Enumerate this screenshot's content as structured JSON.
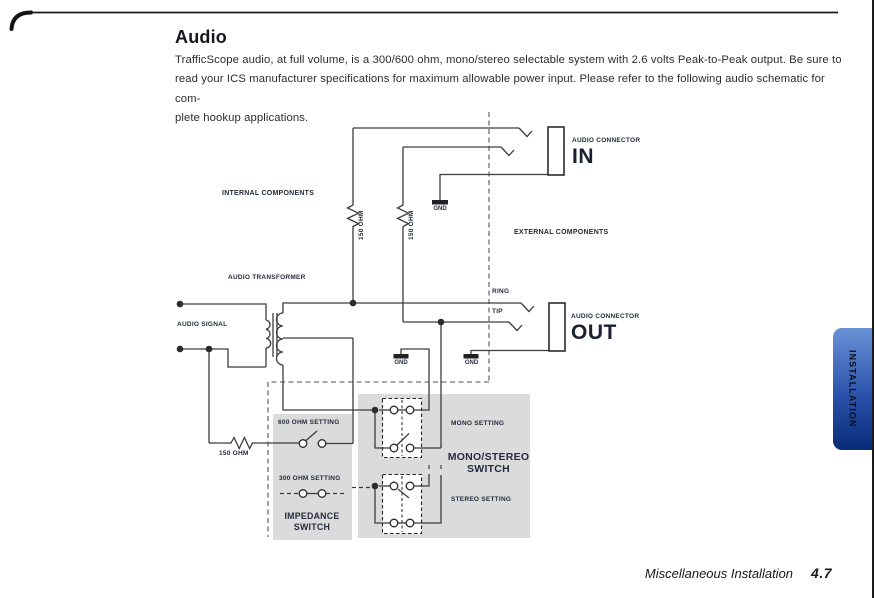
{
  "header": {
    "title": "Audio",
    "paragraph_lines": [
      "TrafficScope audio, at full volume, is a 300/600 ohm, mono/stereo selectable  system with 2.6 volts Peak-to-Peak output.  Be sure to",
      "read your ICS manufacturer specifications for maximum allowable power input. Please refer to the following audio schematic for com-",
      "plete hookup applications."
    ]
  },
  "tab": {
    "label": "INSTALLATION"
  },
  "footer": {
    "section": "Miscellaneous Installation",
    "page_number": "4.7"
  },
  "diagram": {
    "labels": {
      "internal": "INTERNAL COMPONENTS",
      "external": "EXTERNAL COMPONENTS",
      "audio_transformer": "AUDIO TRANSFORMER",
      "audio_signal": "AUDIO SIGNAL",
      "ring": "RING",
      "tip": "TIP",
      "connector_in_caption": "AUDIO CONNECTOR",
      "connector_in_port": "IN",
      "connector_out_caption": "AUDIO CONNECTOR",
      "connector_out_port": "OUT"
    },
    "gnd_labels": [
      "GND",
      "GND",
      "GND"
    ],
    "resistor_labels": [
      "150 OHM",
      "150 OHM",
      "150 OHM"
    ],
    "settings": {
      "ohm600": "600 OHM SETTING",
      "ohm300": "300 OHM SETTING",
      "mono": "MONO SETTING",
      "stereo": "STEREO SETTING"
    },
    "switches": {
      "impedance_line1": "IMPEDANCE",
      "impedance_line2": "SWITCH",
      "monostereo_line1": "MONO/STEREO",
      "monostereo_line2": "SWITCH"
    },
    "colors": {
      "wire": "#3c3c3c",
      "panel_gray": "#dbdbdb",
      "label_navy": "#242b3d",
      "tab_blue_top": "#6a92d8",
      "tab_blue_bottom": "#0a2b78"
    }
  }
}
